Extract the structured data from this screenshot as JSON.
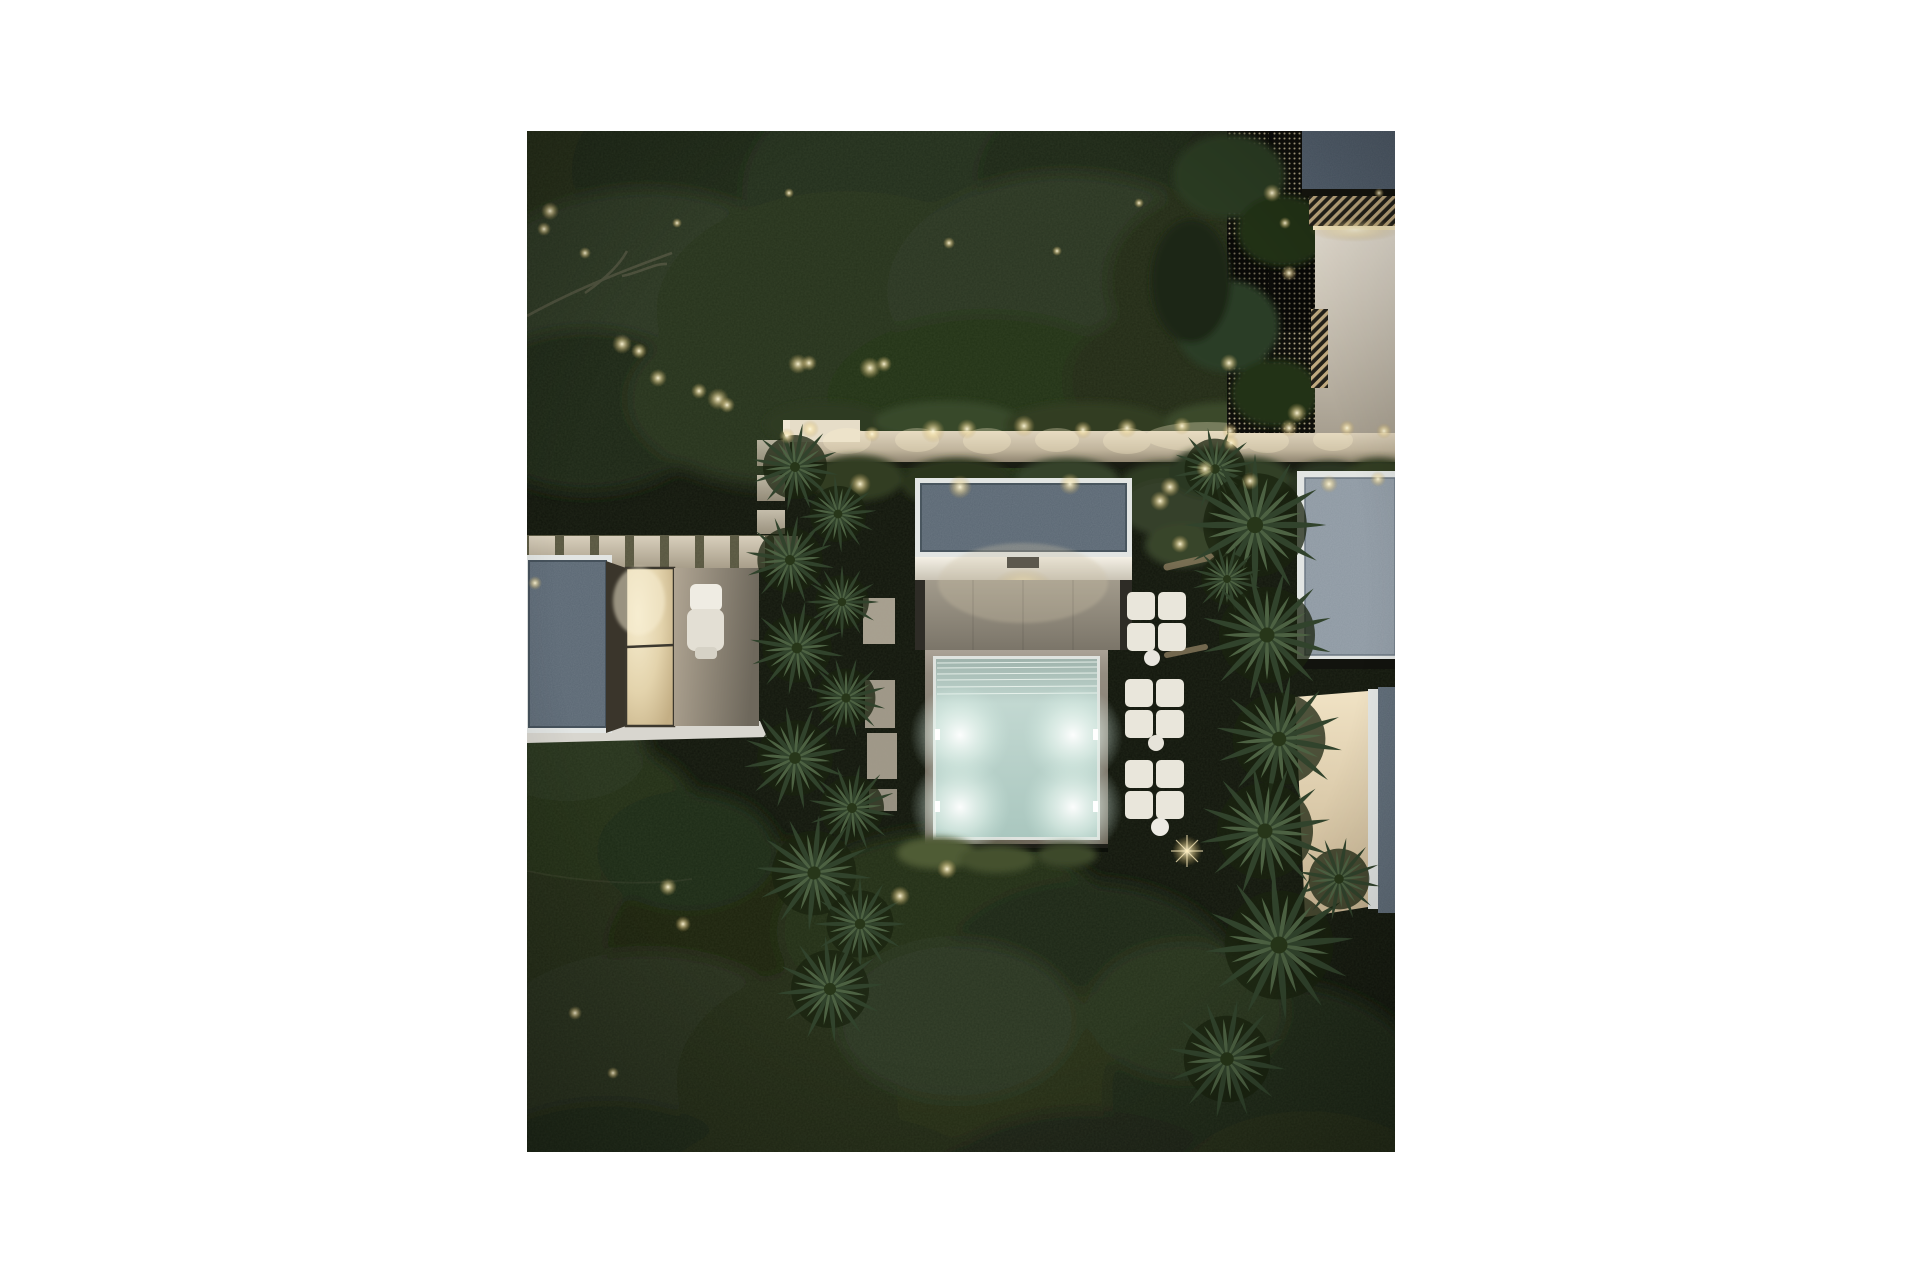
{
  "artwork": {
    "label": "Aerial dusk rendering of a modern villa garden with illuminated pool",
    "description": "Top-down night-time architectural rendering: flat slate-gray speckled roofs of three pavilions, a beige stone terrace leading to a square pool glowing pale aqua from four underwater lights, white modular ottomans with round side tables, a lit cream garden wall with clipped hedges, stepping-stone paths, chains of round spiky palm trees, dense dark foliage dotted with warm landscape lights, all framed by a plain white page margin."
  },
  "colors": {
    "canvas": "#ffffff",
    "lawn-dark": "#11150c",
    "foliage-mid": "#2a3520",
    "roof-slate": "#5a6773",
    "roof-slate-dark": "#4d5a68",
    "roof-slate-light": "#8d98a2",
    "trim-white": "#e2e5e3",
    "wall-cream": "#d2c7b1",
    "terrace-taupe": "#948d7e",
    "pool-water": "#b5d0c9",
    "pool-glow": "#f2fbf7",
    "warm-light": "#f7ecc3",
    "cushion": "#e9e6db",
    "palm-green": "#3a4e35"
  }
}
